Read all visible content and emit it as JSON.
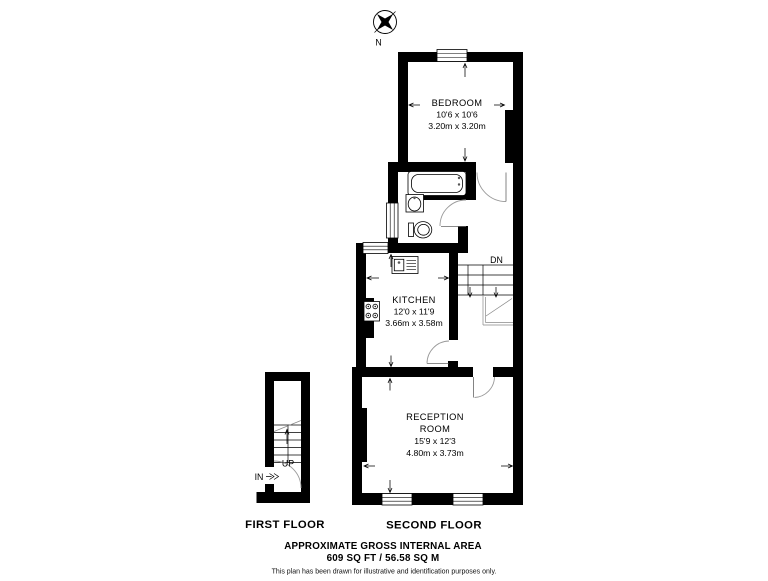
{
  "compass": {
    "north_label": "N"
  },
  "first_floor": {
    "label": "FIRST FLOOR",
    "stairs_label": "UP",
    "entrance_label": "IN"
  },
  "second_floor": {
    "label": "SECOND FLOOR",
    "stairs_label": "DN",
    "rooms": {
      "bedroom": {
        "name": "BEDROOM",
        "imperial": "10'6 x 10'6",
        "metric": "3.20m x 3.20m"
      },
      "kitchen": {
        "name": "KITCHEN",
        "imperial": "12'0 x 11'9",
        "metric": "3.66m x 3.58m"
      },
      "reception": {
        "name_line1": "RECEPTION",
        "name_line2": "ROOM",
        "imperial": "15'9 x 12'3",
        "metric": "4.80m x 3.73m"
      }
    }
  },
  "footer": {
    "area_heading": "APPROXIMATE GROSS INTERNAL AREA",
    "area_value": "609 SQ FT / 56.58 SQ M",
    "disclaimer": "This plan has been drawn for illustrative and identification purposes only."
  },
  "colors": {
    "wall": "#000000",
    "door_arc": "#9a9a9a",
    "background": "#ffffff"
  }
}
